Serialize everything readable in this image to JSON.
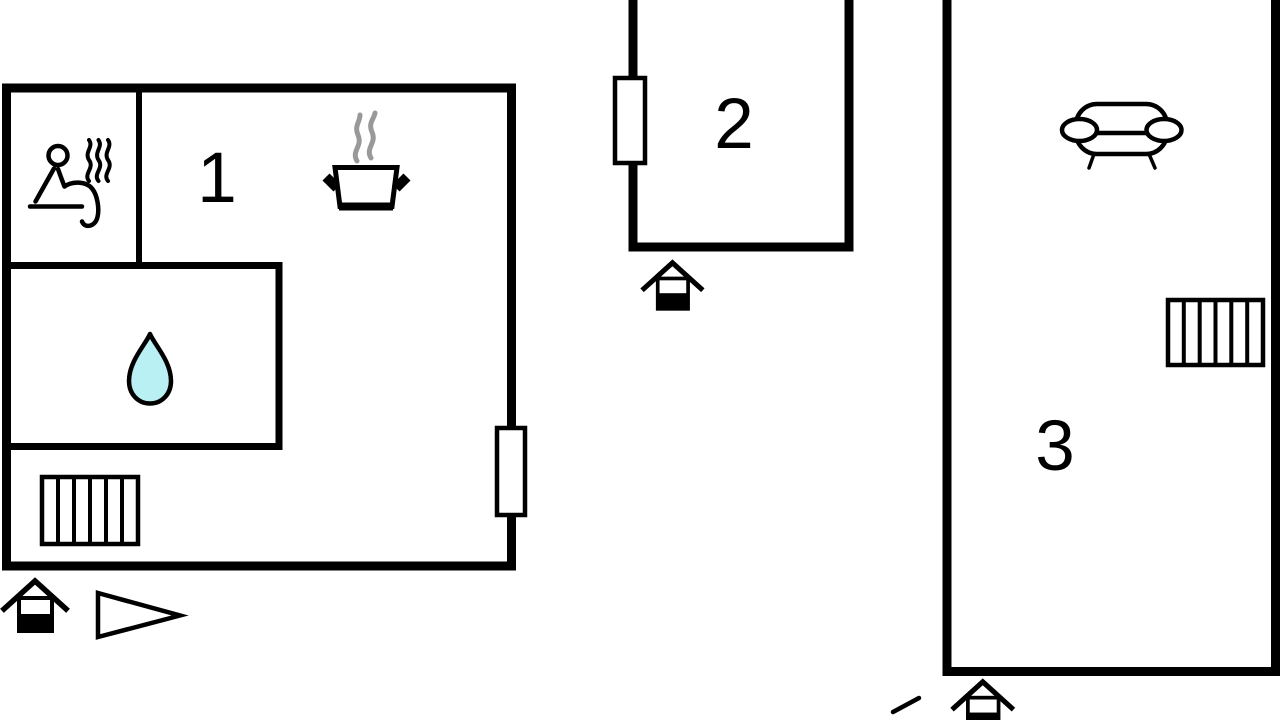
{
  "page": {
    "type": "vacation-home floor plan",
    "background": "#ffffff"
  },
  "colors": {
    "wall": "#000000",
    "outline": "#000000",
    "water_drop": "#b9f0f4",
    "pot_steam": "#999999",
    "label": "#000000",
    "icon_fill": "#ffffff"
  },
  "units": [
    {
      "label": "1",
      "rooms": [
        "main room",
        "sauna room (top-left)",
        "bathroom (water drop)"
      ],
      "icons": [
        "sauna-person-icon",
        "steam-lines-icon",
        "cooking-pot-icon",
        "water-drop-icon",
        "radiator-grill",
        "window-symbol",
        "entrance-house-icon",
        "direction-triangle-icon"
      ]
    },
    {
      "label": "2",
      "rooms": [
        "single room (top edge cut off)"
      ],
      "icons": [
        "window-symbol",
        "entrance-house-icon"
      ]
    },
    {
      "label": "3",
      "rooms": [
        "single tall room (top edge cut off)"
      ],
      "icons": [
        "sofa-icon",
        "radiator-grill",
        "entrance-house-icon",
        "cropped-roof-line"
      ]
    }
  ]
}
